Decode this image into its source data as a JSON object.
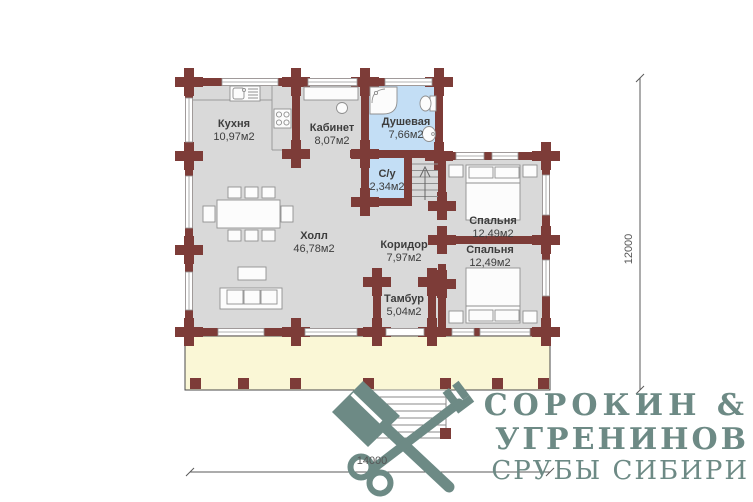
{
  "title": "Floor plan of log house, first floor",
  "rooms": [
    {
      "name": "Кухня",
      "area": "10,97м2"
    },
    {
      "name": "Кабинет",
      "area": "8,07м2"
    },
    {
      "name": "Душевая",
      "area": "7,66м2"
    },
    {
      "name": "С/у",
      "area": "2,34м2"
    },
    {
      "name": "Спальня",
      "area": "12,49м2"
    },
    {
      "name": "Спальня",
      "area": "12,49м2"
    },
    {
      "name": "Холл",
      "area": "46,78м2"
    },
    {
      "name": "Коридор",
      "area": "7,97м2"
    },
    {
      "name": "Тамбур",
      "area": "5,04м2"
    }
  ],
  "dimensions": {
    "width_mm": "14000",
    "height_mm": "12000"
  },
  "logo": {
    "line1": "СОРОКИН &",
    "line2": "УГРЕНИНОВ",
    "line3": "СРУБЫ СИБИРИ"
  },
  "icons": {
    "logo_icon": "crossed-axe-and-key"
  },
  "colors": {
    "wall": "#7d3c38",
    "floor": "#d9d9d9",
    "wet_room": "#c3def5",
    "terrace": "#faf7d6",
    "logo": "#6d8a85",
    "label_text": "#3d3d3d"
  }
}
